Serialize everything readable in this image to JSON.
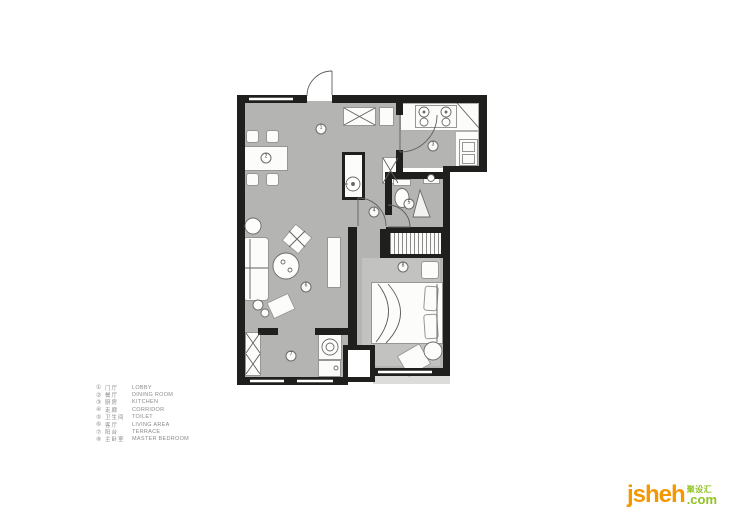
{
  "colors": {
    "floor": "#b4b4b2",
    "wall": "#1f1f1d",
    "furniture": "#fcfcfb",
    "logo_orange": "#f39800",
    "logo_green": "#8fc31f"
  },
  "legend": {
    "items": [
      {
        "num": "①",
        "cn": "门厅",
        "en": "LOBBY"
      },
      {
        "num": "②",
        "cn": "餐厅",
        "en": "DINING ROOM"
      },
      {
        "num": "③",
        "cn": "厨房",
        "en": "KITCHEN"
      },
      {
        "num": "④",
        "cn": "走廊",
        "en": "CORRIDOR"
      },
      {
        "num": "⑤",
        "cn": "卫生间",
        "en": "TOILET"
      },
      {
        "num": "⑥",
        "cn": "客厅",
        "en": "LIVING AREA"
      },
      {
        "num": "⑦",
        "cn": "阳台",
        "en": "TERRACE"
      },
      {
        "num": "⑧",
        "cn": "主卧室",
        "en": "MASTER BEDROOM"
      }
    ]
  },
  "plan": {
    "markers": [
      "1",
      "2",
      "3",
      "4",
      "5",
      "6",
      "7",
      "8"
    ]
  },
  "logo": {
    "name": "jsheh",
    "cn": "聚设汇",
    "tld": ".com"
  }
}
